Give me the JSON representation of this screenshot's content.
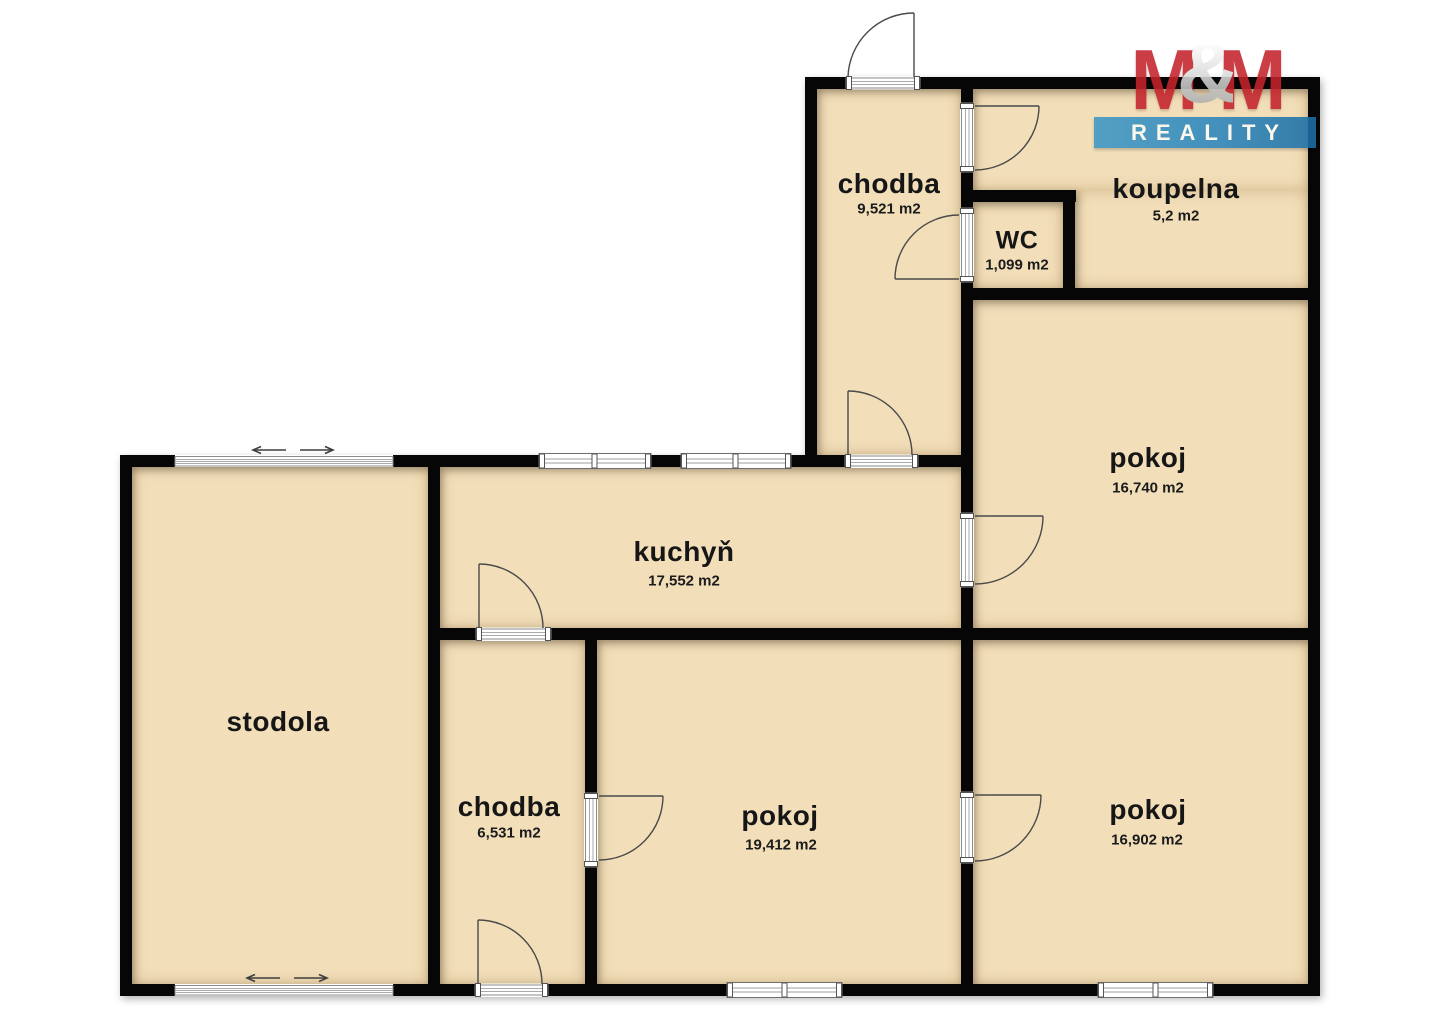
{
  "meta": {
    "type": "real-estate floor plan"
  },
  "branding": {
    "m1": "M",
    "amp": "&",
    "m2": "M",
    "reality": "REALITY",
    "red": "#c4232b",
    "blue": "#2b86bd",
    "silver": "#c9c9c9"
  },
  "rooms": [
    {
      "id": "chodba-top",
      "label": "chodba",
      "area": "9,521 m2"
    },
    {
      "id": "koupelna",
      "label": "koupelna",
      "area": "5,2 m2"
    },
    {
      "id": "wc",
      "label": "WC",
      "area": "1,099 m2"
    },
    {
      "id": "pokoj-top",
      "label": "pokoj",
      "area": "16,740 m2"
    },
    {
      "id": "kuchyn",
      "label": "kuchyň",
      "area": "17,552 m2"
    },
    {
      "id": "stodola",
      "label": "stodola"
    },
    {
      "id": "chodba-bottom",
      "label": "chodba",
      "area": "6,531 m2"
    },
    {
      "id": "pokoj-left",
      "label": "pokoj",
      "area": "19,412 m2"
    },
    {
      "id": "pokoj-right",
      "label": "pokoj",
      "area": "16,902 m2"
    }
  ],
  "colors": {
    "wall": "#060606",
    "room_fill": "#f2dfba",
    "background": "#ffffff"
  }
}
